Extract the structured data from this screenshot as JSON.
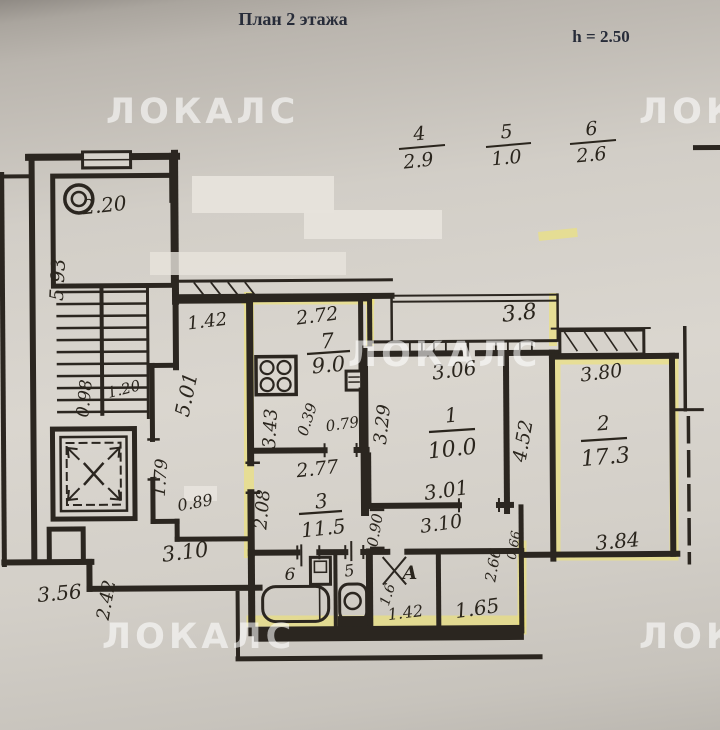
{
  "header": {
    "title": "План 2 этажа",
    "height_note": "h = 2.50"
  },
  "watermark": {
    "text": "ЛОКАЛС"
  },
  "legend_fractions": [
    {
      "num": "4",
      "den": "2.9"
    },
    {
      "num": "5",
      "den": "1.0"
    },
    {
      "num": "6",
      "den": "2.6"
    }
  ],
  "rooms": {
    "kitchen": {
      "number": "7",
      "area": "9.0"
    },
    "living1": {
      "number": "1",
      "area": "10.0"
    },
    "living2": {
      "number": "2",
      "area": "17.3"
    },
    "hall": {
      "number": "3",
      "area": "11.5"
    },
    "bath": {
      "label": "6"
    },
    "wc": {
      "label": "5"
    },
    "storage": {
      "label": "А"
    }
  },
  "dims": {
    "chute_room": "2.20",
    "stairs": "5.93",
    "vestibule": "1.42",
    "corridor_len": "5.01",
    "lift_front": "0.98",
    "lift_side": "1.20",
    "lift_lobby": "1.79",
    "lobby_small": "0.89",
    "lobby_width": "3.10",
    "outer_left": "3.56",
    "outer_step": "2.42",
    "kitchen_top": "2.72",
    "kitchen_left": "3.43",
    "kitchen_nook": "0.39",
    "kitchen_door": "0.79",
    "kitchen_right": "3.29",
    "balcony": "3.8",
    "room1_top": "3.06",
    "room1_bottom": "3.01",
    "room2_height": "4.52",
    "room2_top": "3.80",
    "room2_bottom": "3.84",
    "hall_top": "2.77",
    "hall_left": "2.08",
    "hall_door": "0.90",
    "corridor_bottom": "3.10",
    "storage_side": "1.6",
    "storage_bottom": "1.42",
    "niche_bottom": "1.65",
    "niche_side": "2.66",
    "niche_small": "0.66"
  },
  "colors": {
    "ink": "#2b2620",
    "highlight": "#efe472",
    "paper": "#d6d2cb"
  }
}
